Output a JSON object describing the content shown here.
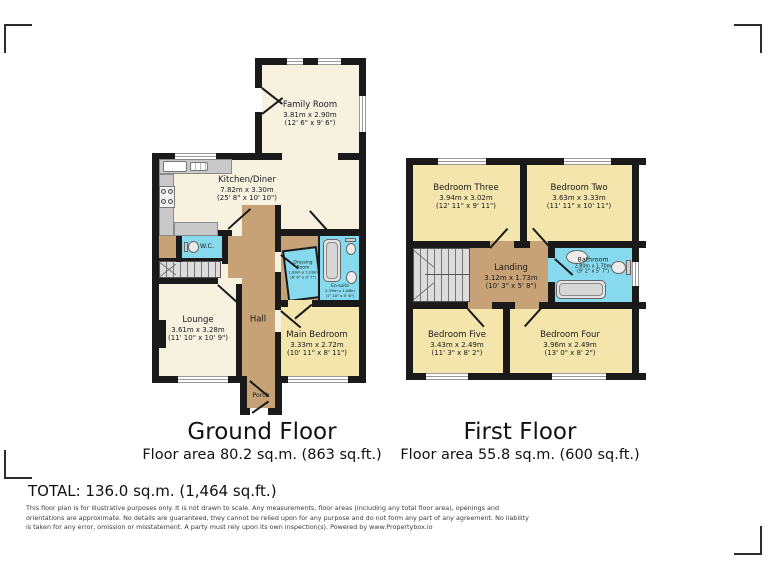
{
  "colors": {
    "wall": "#1a1a1a",
    "cream": "#f7f2df",
    "yellow": "#f3e5ab",
    "cyan": "#87daee",
    "tan": "#c6a276",
    "fixture_gray": "#dcdcdc"
  },
  "ground_floor": {
    "title": "Ground Floor",
    "area_label": "Floor area 80.2 sq.m. (863 sq.ft.)",
    "rooms": {
      "family_room": {
        "name": "Family Room",
        "dims_m": "3.81m x 2.90m",
        "dims_ft": "(12' 6\" x 9' 6\")"
      },
      "kitchen_diner": {
        "name": "Kitchen/Diner",
        "dims_m": "7.82m x 3.30m",
        "dims_ft": "(25' 8\" x 10' 10\")"
      },
      "wc": {
        "name": "W.C."
      },
      "hall": {
        "name": "Hall"
      },
      "porch": {
        "name": "Porch"
      },
      "dressing_room": {
        "name": "Dressing Room",
        "dims_m": "1.99m x 1.09m",
        "dims_ft": "(6' 6\" x 3' 7\")"
      },
      "en_suite": {
        "name": "En-suite",
        "dims_m": "2.39m x 1.68m",
        "dims_ft": "(7' 10\" x 5' 6\")"
      },
      "lounge": {
        "name": "Lounge",
        "dims_m": "3.61m x 3.28m",
        "dims_ft": "(11' 10\" x 10' 9\")"
      },
      "main_bedroom": {
        "name": "Main Bedroom",
        "dims_m": "3.33m x 2.72m",
        "dims_ft": "(10' 11\" x 8' 11\")"
      }
    }
  },
  "first_floor": {
    "title": "First Floor",
    "area_label": "Floor area 55.8 sq.m. (600 sq.ft.)",
    "rooms": {
      "bedroom_three": {
        "name": "Bedroom Three",
        "dims_m": "3.94m x 3.02m",
        "dims_ft": "(12' 11\" x 9' 11\")"
      },
      "bedroom_two": {
        "name": "Bedroom Two",
        "dims_m": "3.63m x 3.33m",
        "dims_ft": "(11' 11\" x 10' 11\")"
      },
      "landing": {
        "name": "Landing",
        "dims_m": "3.12m x 1.73m",
        "dims_ft": "(10' 3\" x 5' 8\")"
      },
      "bathroom": {
        "name": "Bathroom",
        "dims_m": "2.80m x 1.70m",
        "dims_ft": "(9' 2\" x 5' 7\")"
      },
      "bedroom_five": {
        "name": "Bedroom Five",
        "dims_m": "3.43m x 2.49m",
        "dims_ft": "(11' 3\" x 8' 2\")"
      },
      "bedroom_four": {
        "name": "Bedroom Four",
        "dims_m": "3.96m x 2.49m",
        "dims_ft": "(13' 0\" x 8' 2\")"
      }
    }
  },
  "summary": {
    "total": "TOTAL: 136.0 sq.m. (1,464 sq.ft.)"
  },
  "disclaimer": "This floor plan is for illustrative purposes only. It is not drawn to scale. Any measurements, floor areas (including any total floor area), openings and orientations are approximate. No details are guaranteed, they cannot be relied upon for any purpose and do not form any part of any agreement. No liability is taken for any error, omission or misstatement. A party must rely upon its own inspection(s). Powered by www.Propertybox.io"
}
